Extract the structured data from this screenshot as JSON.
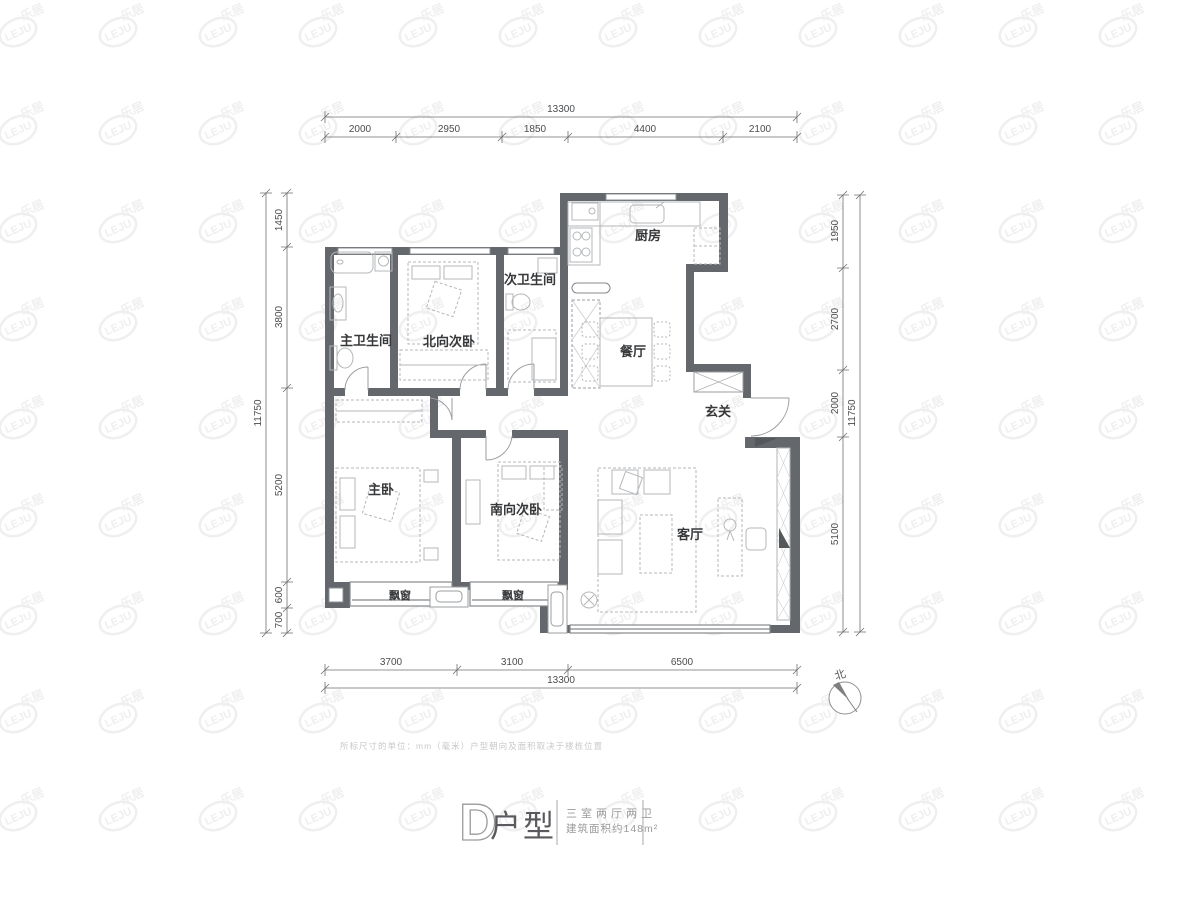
{
  "plan": {
    "rooms": {
      "master_bath": "主卫生间",
      "north_bedroom": "北向次卧",
      "second_bath": "次卫生间",
      "kitchen": "厨房",
      "dining": "餐厅",
      "foyer": "玄关",
      "master_bedroom": "主卧",
      "south_bedroom": "南向次卧",
      "living": "客厅",
      "bay_window": "飘窗"
    },
    "dimensions": {
      "top": {
        "total": "13300",
        "segments": [
          "2000",
          "2950",
          "1850",
          "4400",
          "2100"
        ]
      },
      "bottom": {
        "total": "13300",
        "segments": [
          "3700",
          "3100",
          "6500"
        ]
      },
      "left": {
        "total": "11750",
        "segments": [
          "1450",
          "3800",
          "5200",
          "600",
          "700"
        ]
      },
      "right": {
        "total": "11750",
        "segments": [
          "1950",
          "2700",
          "2000",
          "5100"
        ]
      }
    },
    "north_label": "北"
  },
  "footer": {
    "disclaimer": "所标尺寸的单位：mm（毫米）户型朝向及面积取决于楼栋位置",
    "title_letter": "D",
    "title_suffix": "户型",
    "subtitle_line1": "三室两厅两卫",
    "subtitle_line2": "建筑面积约148m²"
  },
  "watermark": {
    "logo": "LEJU",
    "text": "乐居"
  },
  "colors": {
    "wall": "#64686c",
    "furniture": "#b4b7b9",
    "dimension": "#5a5c5e",
    "label": "#37383a",
    "watermark": "#f0f0f0"
  }
}
